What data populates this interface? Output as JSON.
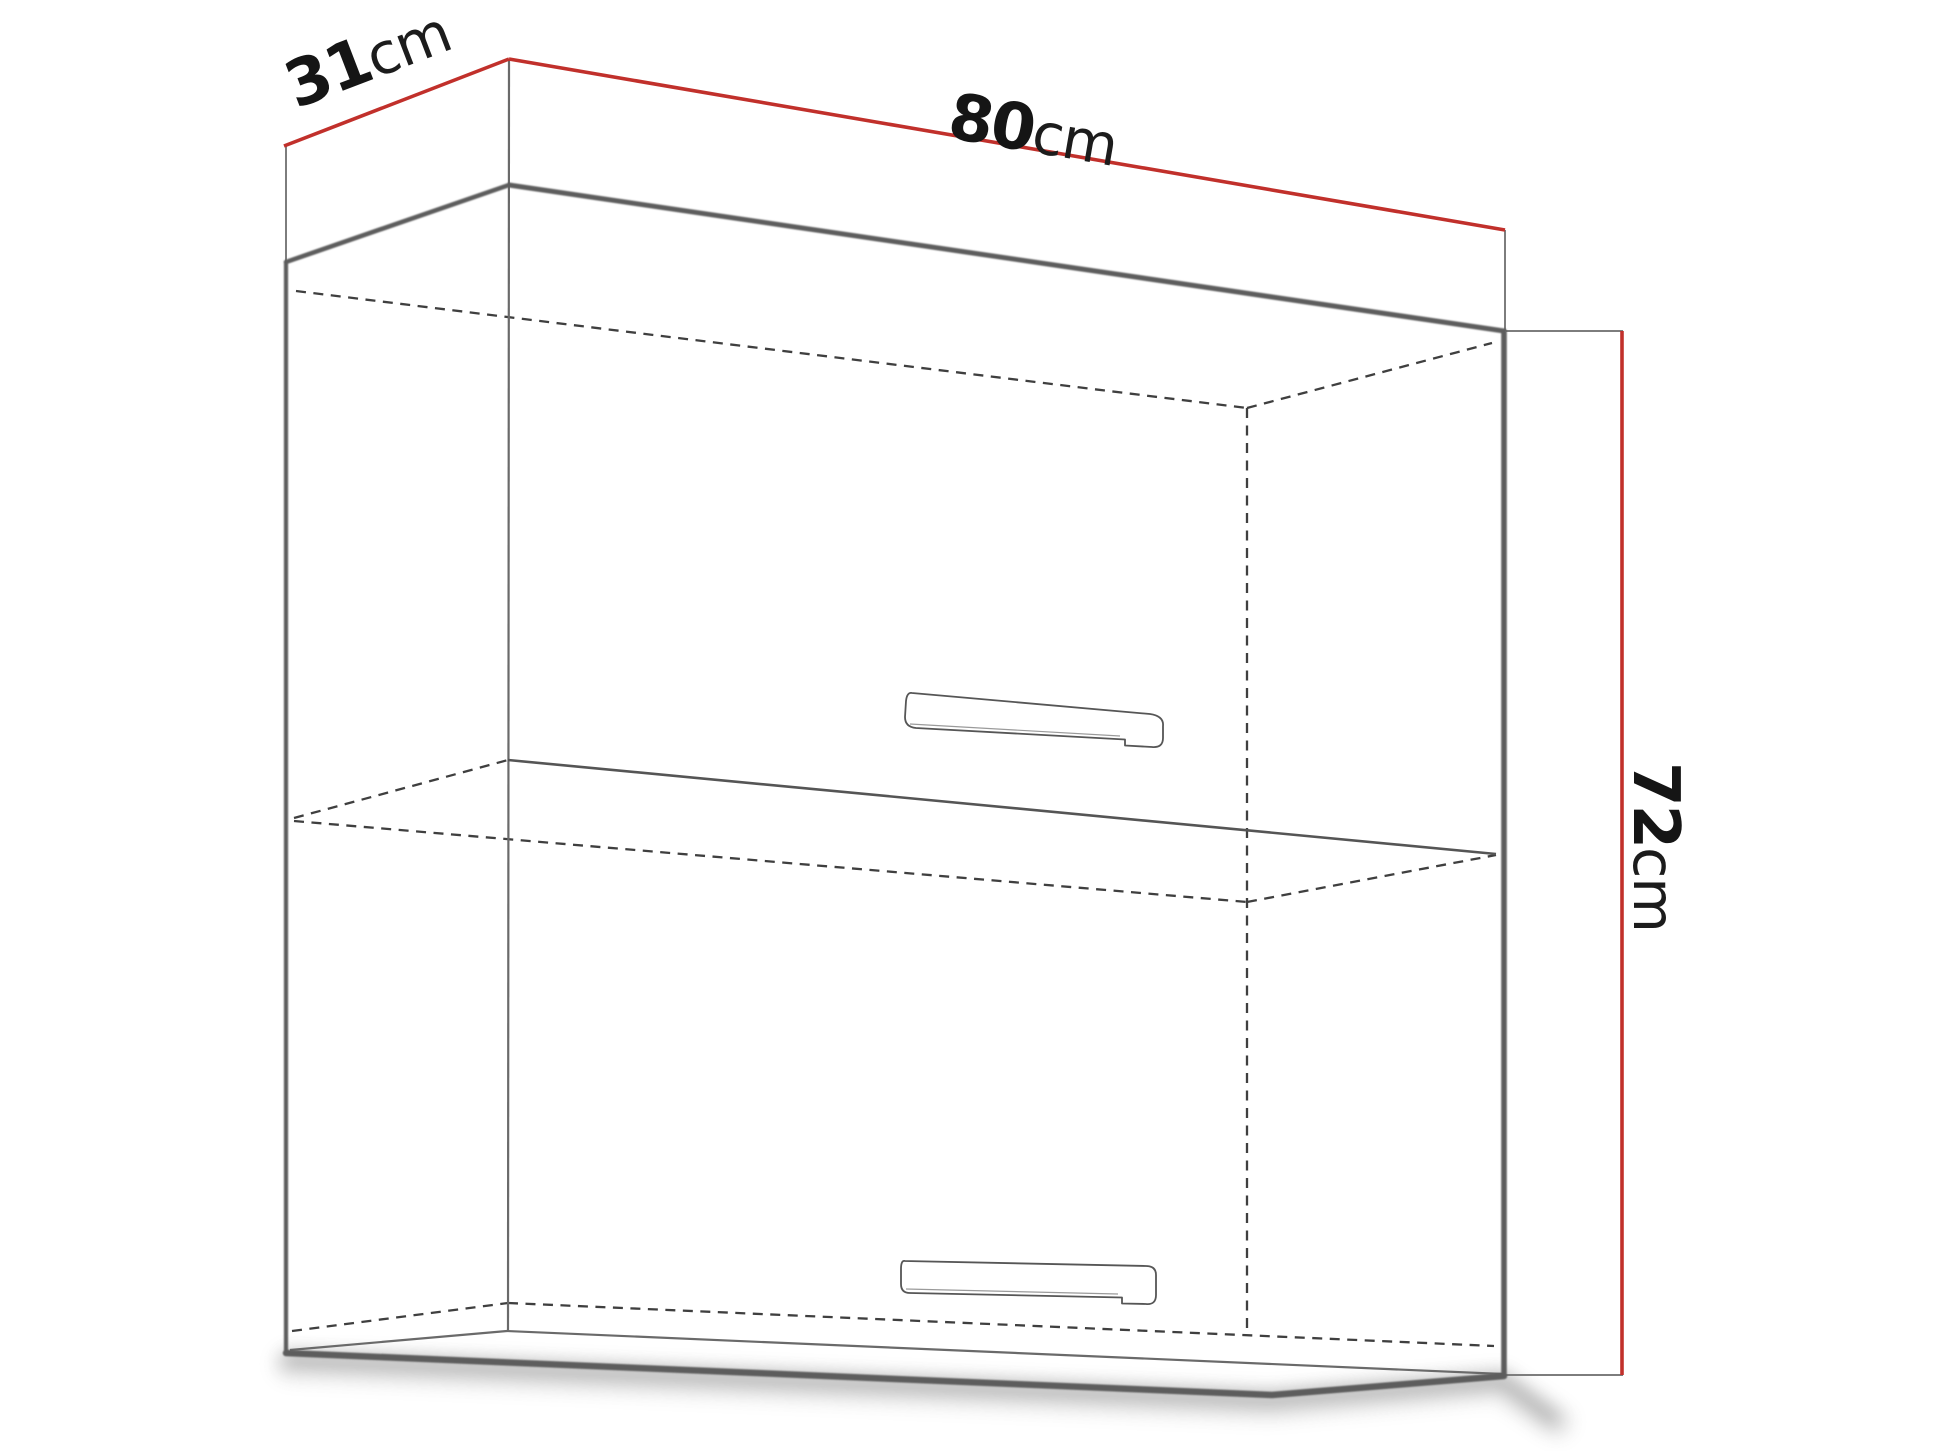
{
  "diagram": {
    "type": "furniture-dimension-diagram",
    "subject": "wall cabinet with two horizontal flip-up doors and middle shelf",
    "labels": {
      "depth": {
        "value": "31",
        "unit": "cm"
      },
      "width": {
        "value": "80",
        "unit": "cm"
      },
      "height": {
        "value": "72",
        "unit": "cm"
      }
    },
    "colors": {
      "dimension_line": "#c1302b",
      "outline": "#5d5d5d",
      "hidden_line": "#3f3f3f",
      "label_text": "#151515",
      "background": "#ffffff"
    }
  }
}
